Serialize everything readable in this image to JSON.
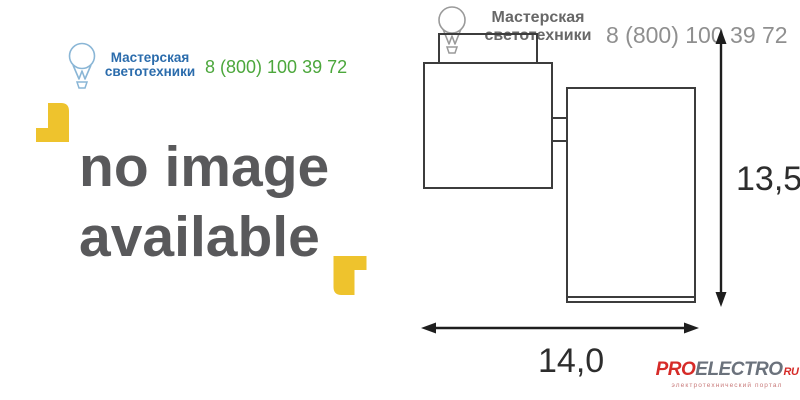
{
  "left_panel": {
    "brand": {
      "name_line1": "Мастерская",
      "name_line2": "светотехники",
      "phone": "8 (800) 100 39 72"
    },
    "placeholder": {
      "line1": "no image",
      "line2": "available"
    }
  },
  "right_panel": {
    "watermark": {
      "name_line1": "Мастерская",
      "name_line2": "светотехники",
      "phone": "8 (800) 100 39 72"
    },
    "dimensions": {
      "height_cm": "13,5",
      "width_cm": "14,0"
    },
    "footer_logo": {
      "part1": "PRO",
      "part2": "ELECTRO",
      "part3": "RU",
      "tagline": "электротехнический портал"
    }
  },
  "icons": {
    "bulb_left": "lightbulb-icon",
    "bulb_watermark": "lightbulb-icon",
    "corner_brackets": "corner-bracket-icon",
    "arrows": "dimension-arrow-icon"
  },
  "colors": {
    "brand_blue": "#2b6cac",
    "phone_green": "#4ca73c",
    "placeholder_gray": "#59595b",
    "bracket_yellow": "#eec32d",
    "drawing_line": "#3c3c3c",
    "watermark_gray": "#8f8f8f",
    "logo_red": "#d62b28",
    "logo_gray": "#6b727c"
  }
}
